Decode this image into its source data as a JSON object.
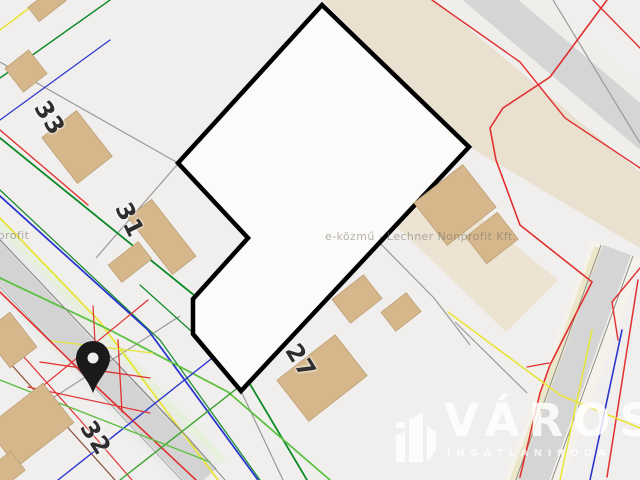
{
  "map": {
    "house_numbers": [
      {
        "label": "33"
      },
      {
        "label": "31"
      },
      {
        "label": "27"
      },
      {
        "label": "32"
      }
    ],
    "watermarks": {
      "text": "e-közmű - Lechner Nonprofit Kft."
    },
    "logo": {
      "brand": "VÁROS",
      "subtitle": "INGATLANIRODA"
    },
    "marker": {
      "type": "location-pin",
      "color": "#1a1a1a"
    },
    "colors": {
      "background": "#f1efed",
      "parcel_fill": "#fcfbf9",
      "parcel_outline": "#000000",
      "building_fill": "#d6b78c",
      "road_fill": "#d3d3d3",
      "zone_beige": "#eae0d0",
      "utility_red": "#e03030",
      "utility_dark_green": "#0f8a28",
      "utility_light_green": "#5ec143",
      "utility_blue": "#2b35d0",
      "utility_yellow": "#e8e438",
      "utility_gray": "#8a8a8a",
      "utility_brown": "#8a4a35"
    }
  }
}
